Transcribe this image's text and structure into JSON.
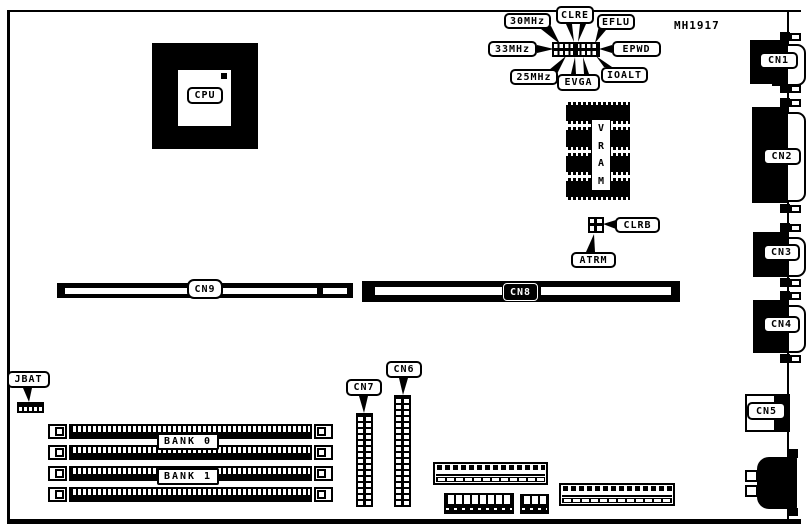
{
  "board": {
    "part_number": "MH1917",
    "cpu": {
      "label": "CPU"
    },
    "vram": {
      "letters": [
        "V",
        "R",
        "A",
        "M"
      ]
    },
    "clock_jumpers": {
      "mhz30": "30MHz",
      "clre": "CLRE",
      "eflu": "EFLU",
      "mhz33": "33MHz",
      "epwd": "EPWD",
      "mhz25": "25MHz",
      "evga": "EVGA",
      "ioalt": "IOALT"
    },
    "misc_jumpers": {
      "clrb": "CLRB",
      "atrm": "ATRM",
      "jbat": "JBAT"
    },
    "slots": {
      "cn9": "CN9",
      "cn8": "CN8",
      "bank0": "BANK 0",
      "bank1": "BANK 1"
    },
    "pin_headers": {
      "cn7": "CN7",
      "cn6": "CN6"
    },
    "rear_connectors": {
      "cn1": "CN1",
      "cn2": "CN2",
      "cn3": "CN3",
      "cn4": "CN4",
      "cn5": "CN5"
    }
  }
}
